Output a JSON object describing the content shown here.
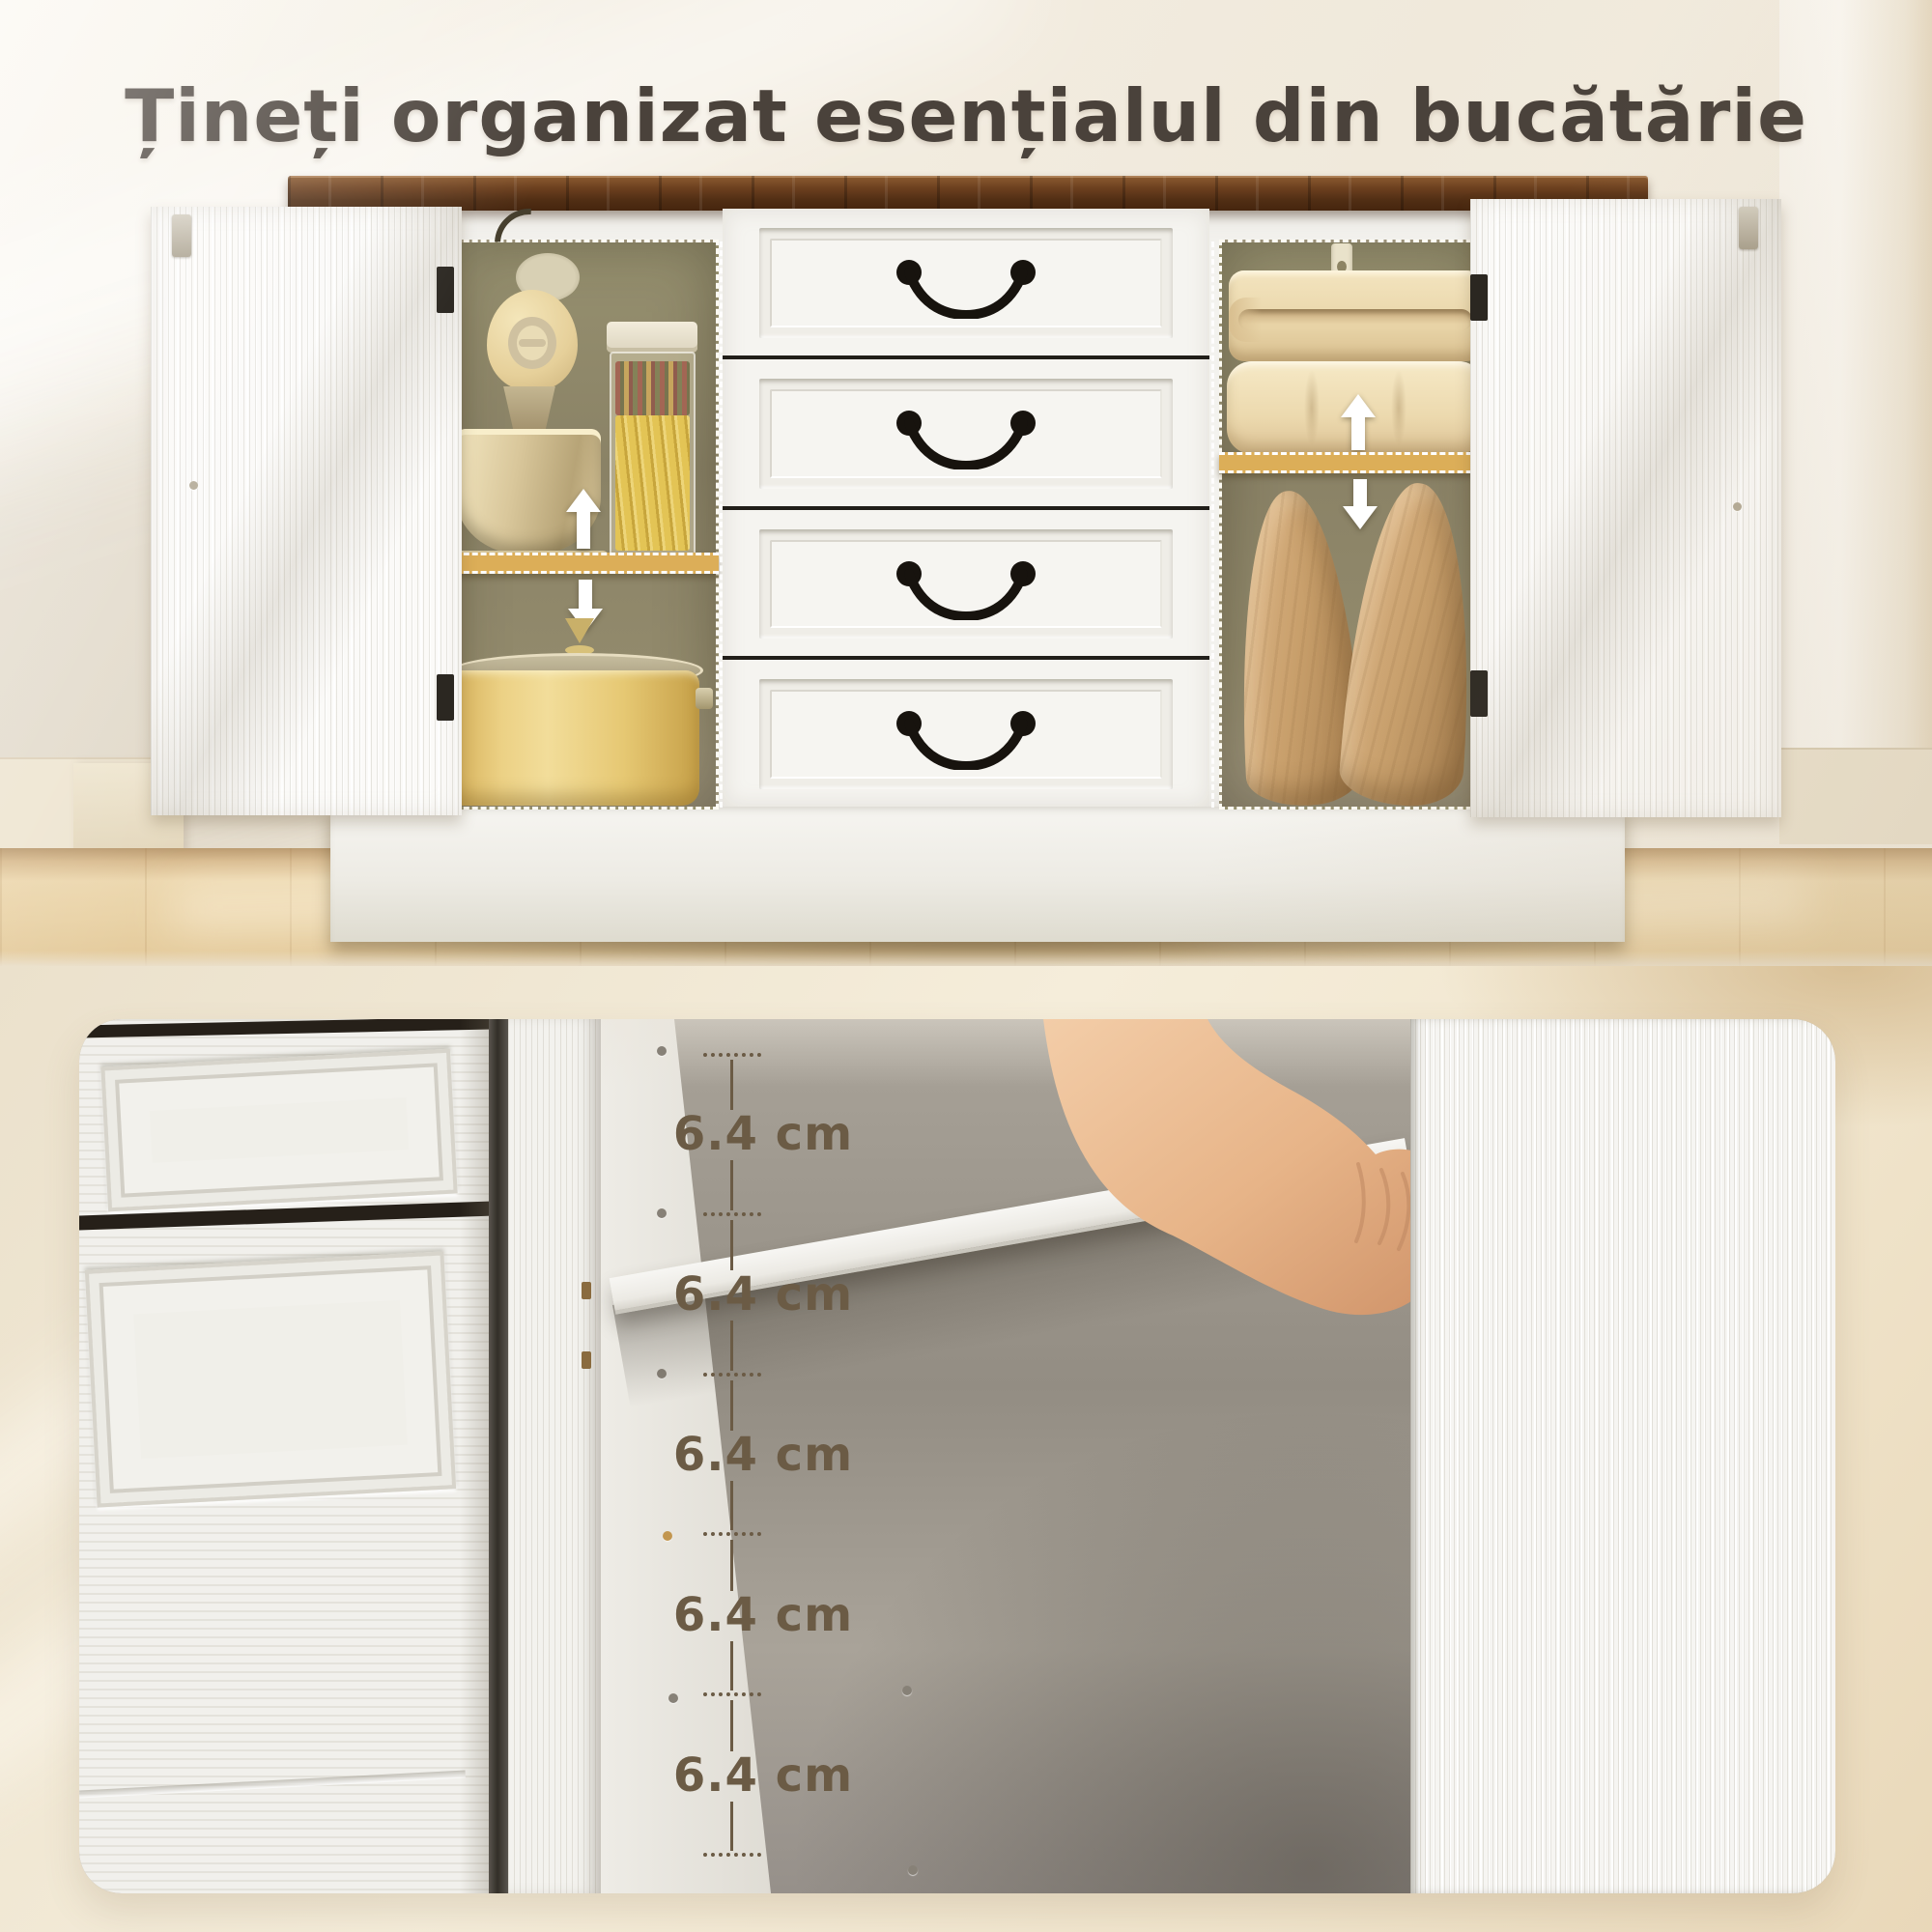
{
  "title": "Țineți organizat esențialul din bucătărie",
  "hero": {
    "icons": {
      "up_arrow": "adjustable-shelf-up-arrow",
      "down_arrow": "adjustable-shelf-down-arrow",
      "drawer_handle": "black-bail-pull-handle"
    },
    "contents": {
      "left_compartment": [
        "stand-mixer",
        "pasta-jar",
        "lidded-pot"
      ],
      "right_compartment": [
        "folded-blanket",
        "comforter",
        "wooden-pillows"
      ],
      "center": [
        "drawer",
        "drawer",
        "drawer",
        "drawer"
      ]
    }
  },
  "measurements": {
    "labels": [
      "6.4 cm",
      "6.4 cm",
      "6.4 cm",
      "6.4 cm",
      "6.4 cm"
    ],
    "value": "6.4",
    "unit": "cm"
  },
  "colors": {
    "title_text": "#4a423b",
    "measurement_text": "#6b5b45",
    "wood_countertop": "#5e3a1e",
    "accent_shelf": "#dcae58",
    "cabinet_white": "#f4f3ef",
    "interior_back": "#8a8266",
    "wall": "#f2ecdf",
    "floor": "#e9d2a6",
    "bottom_background": "#f0e6d0"
  }
}
